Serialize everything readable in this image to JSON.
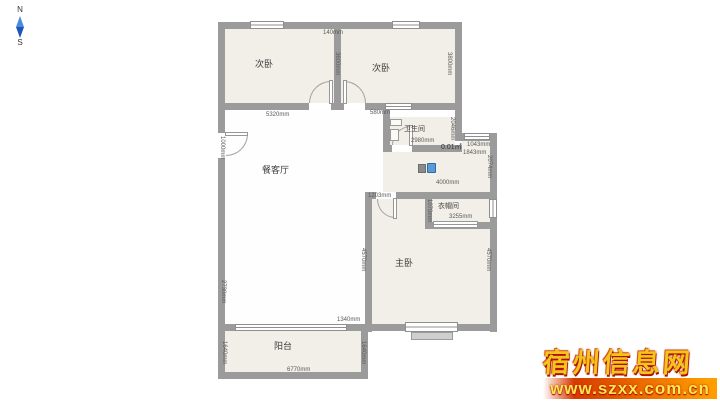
{
  "compass": {
    "north_label": "N",
    "south_label": "S"
  },
  "rooms": {
    "bedroom_left": {
      "label": "次卧"
    },
    "bedroom_right": {
      "label": "次卧"
    },
    "bathroom": {
      "label": "卫生间"
    },
    "living_dining": {
      "label": "餐客厅"
    },
    "cloakroom": {
      "label": "衣帽间"
    },
    "master_bedroom": {
      "label": "主卧"
    },
    "balcony": {
      "label": "阳台"
    }
  },
  "dimensions": {
    "top_wall_gap": "140mm",
    "bedroom_left_depth": "3600mm",
    "bedroom_right_depth": "3800mm",
    "living_width": "5320mm",
    "bath_offset": "580mm",
    "bathroom_width": "2980mm",
    "bathroom_depth": "2046mm",
    "tiny_area": "0.01㎡",
    "corridor_width": "1043mm",
    "hall_right_width": "1843mm",
    "corridor_depth": "2074mm",
    "hall_width": "4000mm",
    "master_door_offset": "1203mm",
    "cloakroom_depth": "1070mm",
    "cloakroom_width": "3255mm",
    "master_depth_left": "4570mm",
    "master_depth_right": "4570mm",
    "entry_door_width": "1000mm",
    "living_left_segment": "2730mm",
    "bay_offset": "1340mm",
    "balcony_width": "6770mm",
    "balcony_depth_left": "1640mm",
    "balcony_depth_right": "1640mm"
  },
  "watermark": {
    "site_name": "宿州信息网",
    "site_url": "www.szxx.com.cn"
  },
  "colors": {
    "wall": "#9b9b9b",
    "room_floor": "#f2efe8",
    "living_floor": "#fefefe",
    "compass_blue": "#4a8be0",
    "watermark_gold": "#f2c51d",
    "watermark_red": "#d63a00"
  }
}
